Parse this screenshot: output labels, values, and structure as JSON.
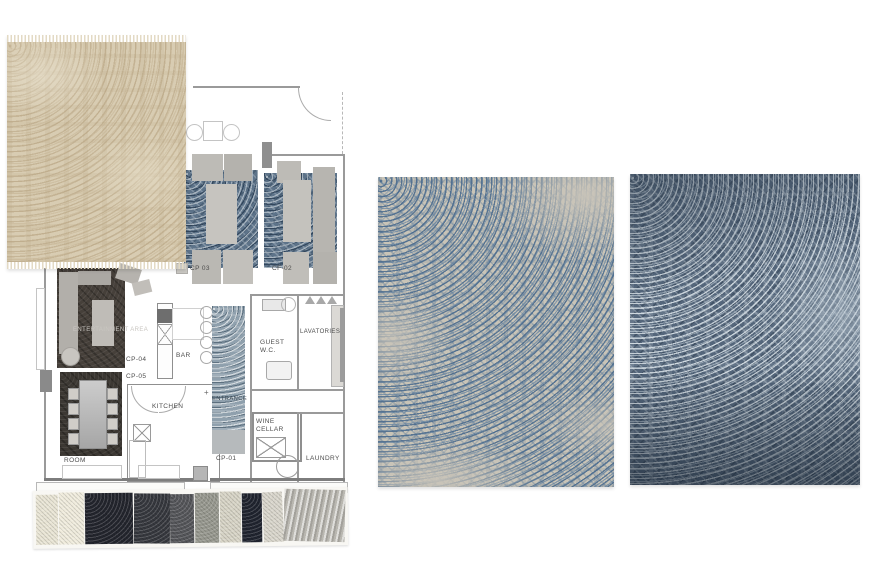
{
  "plan": {
    "rooms": {
      "entertainment_area": "ENTERTAINMENT AREA",
      "bar": "BAR",
      "kitchen": "KITCHEN",
      "room": "ROOM",
      "entrance": "ENTRANCE",
      "guest_wc_line1": "GUEST",
      "guest_wc_line2": "W.C.",
      "lavatories": "LAVATORIES",
      "wine_cellar_line1": "WINE",
      "wine_cellar_line2": "CELLAR",
      "laundry": "LAUNDRY"
    },
    "codes": {
      "cp03": "CP 03",
      "cf02": "CF-02",
      "cp04": "CP-04",
      "cp05": "CP-05",
      "cp01": "CP-01"
    },
    "markers": {
      "cross": "+"
    }
  },
  "samples": {
    "beige_rug": {
      "label": "beige damask rug sample",
      "bg": "#d8ccb2",
      "pattern": "#c0ae90"
    },
    "light_blue_rug": {
      "label": "ivory and blue damask rug sample",
      "bg": "#c9c4b7",
      "pattern": "#54769b"
    },
    "dark_blue_rug": {
      "label": "slate blue damask rug sample",
      "bg": "#54667b",
      "pattern": "#dce3e8"
    }
  },
  "fabric_swatches": [
    {
      "name": "cream-panel",
      "color": "#e9e5d5"
    },
    {
      "name": "ivory-panel",
      "color": "#f0ecdd"
    },
    {
      "name": "navy-boucle",
      "color": "#23252d"
    },
    {
      "name": "charcoal-boucle",
      "color": "#36383e"
    },
    {
      "name": "graphite-tweed",
      "color": "#55565a"
    },
    {
      "name": "grey-boucle",
      "color": "#97988f"
    },
    {
      "name": "light-boucle",
      "color": "#d7d4c6"
    },
    {
      "name": "navy-solid",
      "color": "#20242f"
    },
    {
      "name": "pale-weave",
      "color": "#d9d6cc"
    },
    {
      "name": "silver-stripe",
      "color": "#b9b7b0"
    }
  ]
}
